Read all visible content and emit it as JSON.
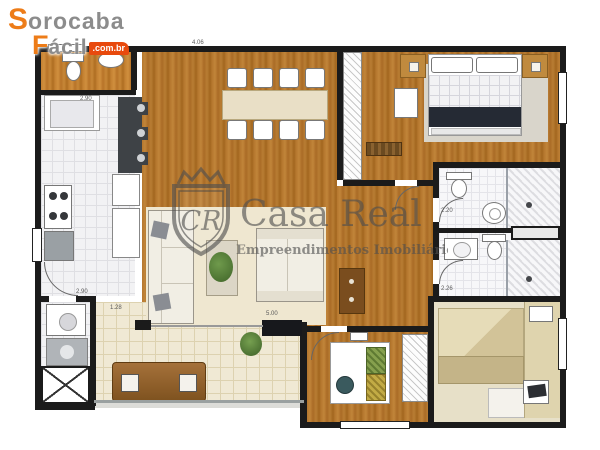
{
  "header_logo": {
    "word1_initial": "S",
    "word1_rest": "orocaba",
    "word2_initial": "F",
    "word2_rest": "ácil",
    "domain_badge": ".com.br",
    "accent_color": "#ED7C18",
    "text_color": "#8C8C8C",
    "badge_color": "#E8490D"
  },
  "watermark": {
    "brand": "Casa Real",
    "tagline": "Empreendimentos Imobiliários",
    "monogram": "CR",
    "color": "#4F4F4F"
  },
  "floorplan": {
    "type": "apartment-floor-plan",
    "rooms": [
      "service-wc",
      "kitchen",
      "laundry",
      "dining-room",
      "living-room",
      "hallway",
      "master-suite",
      "closet",
      "suite-bathroom",
      "social-bathroom",
      "bedroom-2",
      "home-office",
      "gourmet-balcony"
    ],
    "dimension_labels": [
      {
        "label": "4.06"
      },
      {
        "label": "2.90"
      },
      {
        "label": "2.90"
      },
      {
        "label": "1.28"
      },
      {
        "label": "5.00"
      },
      {
        "label": "2.20"
      },
      {
        "label": "2.26"
      }
    ],
    "colors": {
      "wood": "#B5772E",
      "kitchen_tile": "#F2F2F4",
      "balcony_tile": "#F0E9D4",
      "wall": "#1B1B1B",
      "counter_dark": "#3E4246",
      "plant_green": "#4C7A33"
    }
  }
}
